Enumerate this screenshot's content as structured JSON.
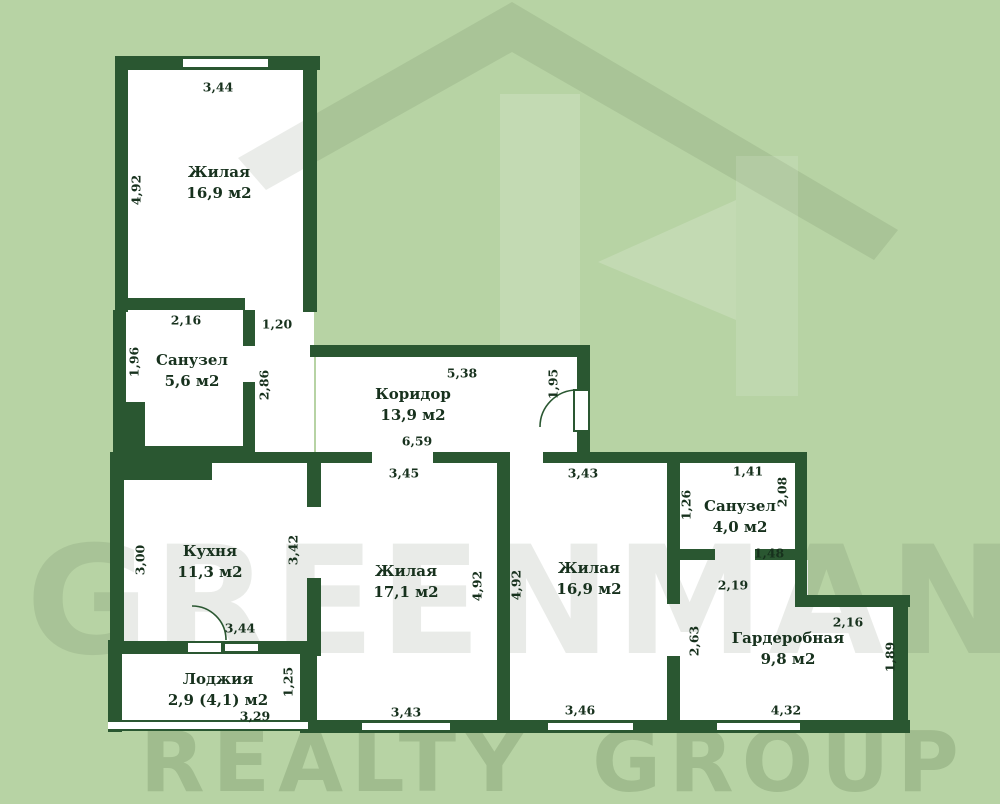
{
  "watermark": {
    "brand": "GREENMAN",
    "tagline": "REALTY GROUP"
  },
  "plan": {
    "rooms": [
      {
        "id": "living-top",
        "name": "Жилая",
        "area": "16,9 м2",
        "cx": 219,
        "cy": 183
      },
      {
        "id": "bathroom-1",
        "name": "Санузел",
        "area": "5,6 м2",
        "cx": 192,
        "cy": 371
      },
      {
        "id": "corridor",
        "name": "Коридор",
        "area": "13,9 м2",
        "cx": 413,
        "cy": 405
      },
      {
        "id": "kitchen",
        "name": "Кухня",
        "area": "11,3 м2",
        "cx": 210,
        "cy": 562
      },
      {
        "id": "living-mid",
        "name": "Жилая",
        "area": "17,1 м2",
        "cx": 406,
        "cy": 582
      },
      {
        "id": "living-right",
        "name": "Жилая",
        "area": "16,9 м2",
        "cx": 589,
        "cy": 579
      },
      {
        "id": "bathroom-2",
        "name": "Санузел",
        "area": "4,0 м2",
        "cx": 740,
        "cy": 517
      },
      {
        "id": "wardrobe",
        "name": "Гардеробная",
        "area": "9,8 м2",
        "cx": 788,
        "cy": 649
      },
      {
        "id": "loggia",
        "name": "Лоджия",
        "area": "2,9 (4,1) м2",
        "cx": 218,
        "cy": 690
      }
    ],
    "dimensions": [
      {
        "v": "3,44",
        "x": 218,
        "y": 87,
        "rot": false
      },
      {
        "v": "4,92",
        "x": 136,
        "y": 190,
        "rot": true
      },
      {
        "v": "2,16",
        "x": 186,
        "y": 320,
        "rot": false
      },
      {
        "v": "1,96",
        "x": 134,
        "y": 362,
        "rot": true
      },
      {
        "v": "1,20",
        "x": 277,
        "y": 324,
        "rot": false
      },
      {
        "v": "2,86",
        "x": 264,
        "y": 385,
        "rot": true
      },
      {
        "v": "5,38",
        "x": 462,
        "y": 373,
        "rot": false
      },
      {
        "v": "1,95",
        "x": 553,
        "y": 384,
        "rot": true
      },
      {
        "v": "6,59",
        "x": 417,
        "y": 441,
        "rot": false
      },
      {
        "v": "3,45",
        "x": 404,
        "y": 473,
        "rot": false
      },
      {
        "v": "3,43",
        "x": 583,
        "y": 473,
        "rot": false
      },
      {
        "v": "3,00",
        "x": 140,
        "y": 560,
        "rot": true
      },
      {
        "v": "3,42",
        "x": 293,
        "y": 550,
        "rot": true
      },
      {
        "v": "4,92",
        "x": 477,
        "y": 586,
        "rot": true
      },
      {
        "v": "4,92",
        "x": 516,
        "y": 585,
        "rot": true
      },
      {
        "v": "3,44",
        "x": 240,
        "y": 628,
        "rot": false
      },
      {
        "v": "1,25",
        "x": 288,
        "y": 682,
        "rot": true
      },
      {
        "v": "3,29",
        "x": 255,
        "y": 716,
        "rot": false
      },
      {
        "v": "3,43",
        "x": 406,
        "y": 712,
        "rot": false
      },
      {
        "v": "3,46",
        "x": 580,
        "y": 710,
        "rot": false
      },
      {
        "v": "1,41",
        "x": 748,
        "y": 471,
        "rot": false
      },
      {
        "v": "1,26",
        "x": 686,
        "y": 505,
        "rot": true
      },
      {
        "v": "2,08",
        "x": 782,
        "y": 492,
        "rot": true
      },
      {
        "v": "1,48",
        "x": 769,
        "y": 553,
        "rot": false
      },
      {
        "v": "2,19",
        "x": 733,
        "y": 585,
        "rot": false
      },
      {
        "v": "2,63",
        "x": 694,
        "y": 641,
        "rot": true
      },
      {
        "v": "2,16",
        "x": 848,
        "y": 622,
        "rot": false
      },
      {
        "v": "1,89",
        "x": 890,
        "y": 657,
        "rot": true
      },
      {
        "v": "4,32",
        "x": 786,
        "y": 710,
        "rot": false
      }
    ]
  }
}
